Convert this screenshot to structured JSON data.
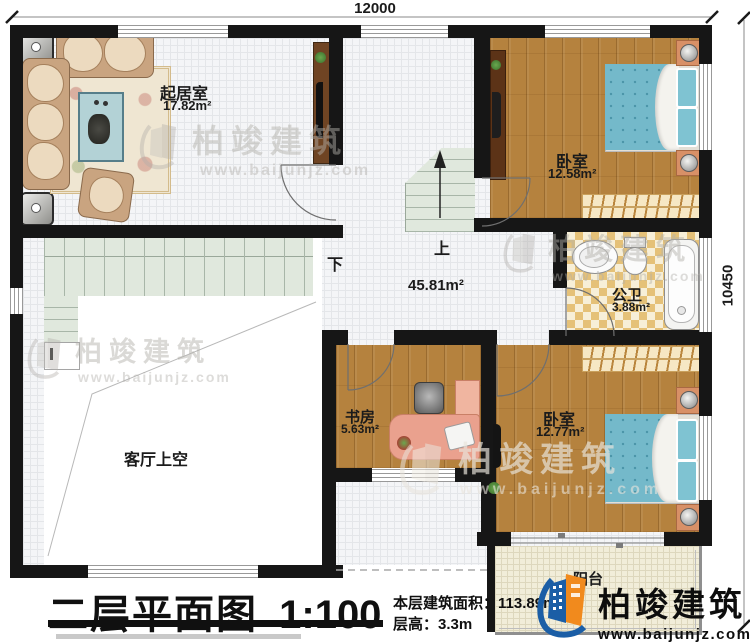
{
  "dimensions": {
    "top": "12000",
    "right": "10450"
  },
  "rooms": {
    "living": {
      "name": "起居室",
      "area": "17.82m²"
    },
    "bedroom1": {
      "name": "卧室",
      "area": "12.58m²"
    },
    "bathroom": {
      "name": "公卫",
      "area": "3.88m²"
    },
    "hall": {
      "area": "45.81m²"
    },
    "study": {
      "name": "书房",
      "area": "5.63m²"
    },
    "bedroom2": {
      "name": "卧室",
      "area": "12.77m²"
    },
    "void": {
      "name": "客厅上空"
    },
    "balcony": {
      "name": "阳台"
    }
  },
  "stairs": {
    "up": "上",
    "down": "下"
  },
  "titleblock": {
    "title": "二层平面图",
    "scale": "1:100",
    "area_label": "本层建筑面积：",
    "area_value": "113.89m²",
    "floor_height_label": "层高：",
    "floor_height_value": "3.3m"
  },
  "brand": {
    "name": "柏竣建筑",
    "url": "www.baijunjz.com"
  },
  "watermark": {
    "name": "柏竣建筑",
    "url": "www.baijunjz.com"
  },
  "colors": {
    "wall": "#161616",
    "wood": "#b5823e",
    "tile": "#f4f5f7",
    "stair": "#e0e8dd",
    "checker_dark": "#e5c178",
    "checker_light": "#f7efd8",
    "bed_blue": "#74b9ca",
    "brand_blue": "#1b5ea6",
    "brand_orange": "#f18a1d"
  }
}
